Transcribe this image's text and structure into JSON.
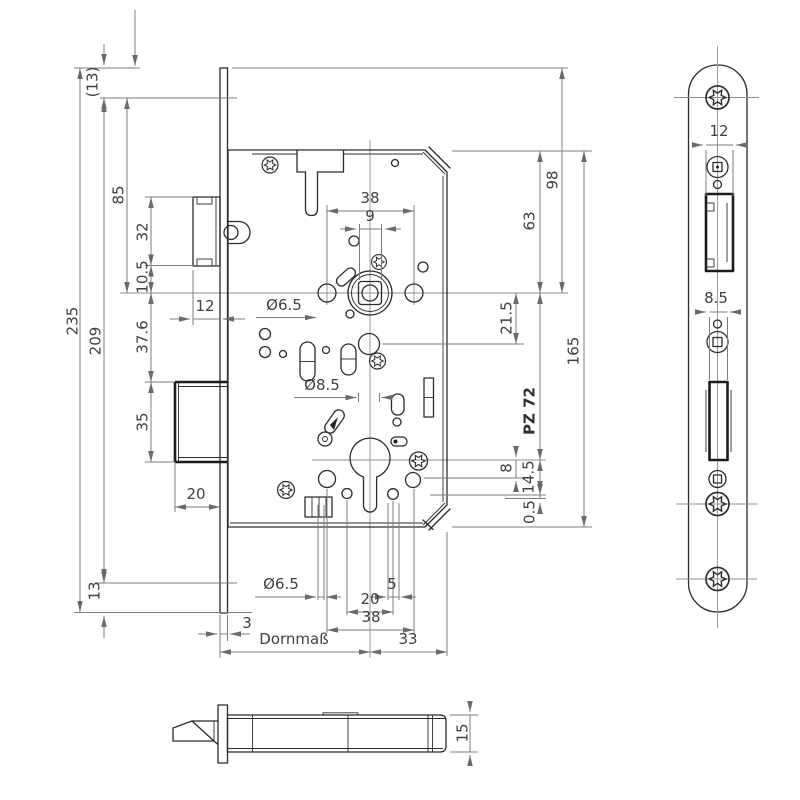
{
  "colors": {
    "background": "#ffffff",
    "part_line": "#2b2b2b",
    "dimension_line": "#7d7d7d",
    "label_text": "#3f3f3f"
  },
  "main_view": {
    "left_dims": {
      "overall_length": "235",
      "screw_hole_spacing": "209",
      "top_screw_offset": "(13)",
      "screw_to_spindle_axis": "85",
      "latch_height": "32",
      "latch_to_spindle_axis": "10.5",
      "spindle_to_deadbolt": "37.6",
      "deadbolt_height": "35",
      "deadbolt_width": "20",
      "bottom_screw_offset": "13",
      "latch_protrusion": "12",
      "faceplate_thickness": "3"
    },
    "top_dims": {
      "hub_hole_spacing": "38",
      "follower_square": "9",
      "hub_hole_dia": "Ø6.5",
      "spindle_hole_dia": "Ø8.5"
    },
    "right_dims": {
      "case_top_to_spindle": "63",
      "plate_top_to_spindle": "98",
      "spindle_to_hole": "21.5",
      "case_height": "165",
      "centre_distance": "PZ 72",
      "cyl_axis_to_hole": "8",
      "cyl_axis_to_lower_hole": "14.5",
      "clearance": "0.5"
    },
    "bottom_dims": {
      "hole_dia": "Ø6.5",
      "hole_offset": "5",
      "hole_pair_spacing": "20",
      "screw_hole_spacing": "38",
      "backset_label": "Dornmaß",
      "axis_to_case_back": "33"
    }
  },
  "faceplate_view": {
    "latch_cutout_width": "12",
    "deadbolt_cutout_width": "8.5"
  },
  "bottom_view": {
    "case_thickness": "15"
  }
}
